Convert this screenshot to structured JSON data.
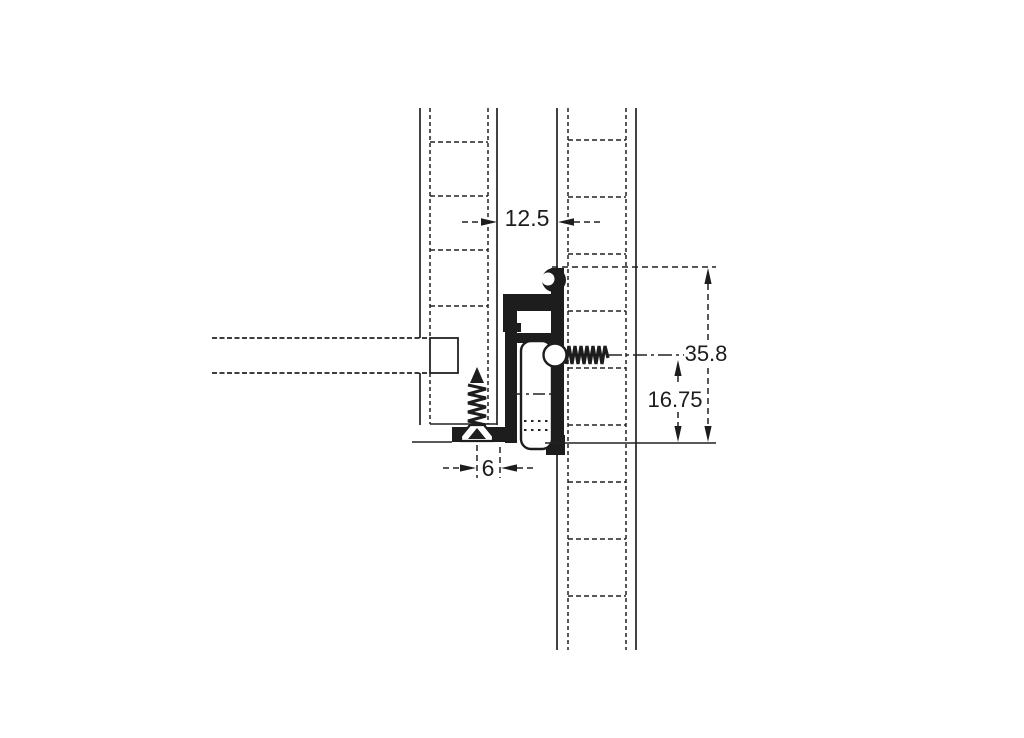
{
  "colors": {
    "line": "#222222",
    "profile_fill": "#1d1d1d",
    "background": "#ffffff"
  },
  "labels": {
    "panel_gap": "12.5",
    "total_height": "35.8",
    "axis_height": "16.75",
    "edge_offset": "6"
  }
}
